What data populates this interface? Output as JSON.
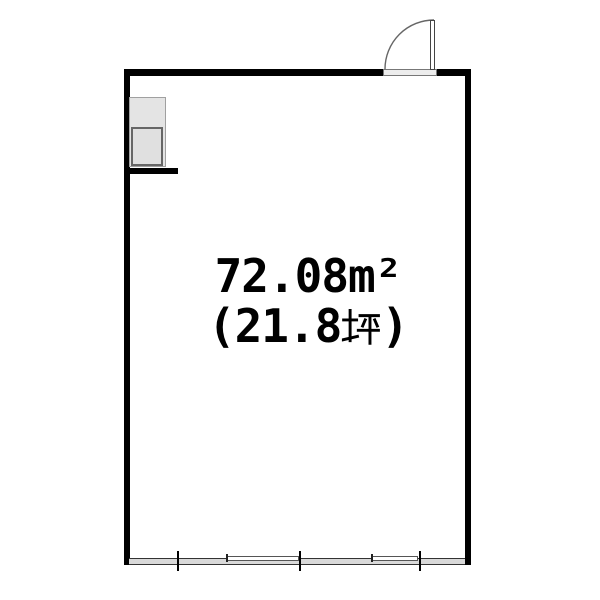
{
  "floorplan": {
    "area_sqm_label": "72.08m²",
    "tsubo_prefix": "(21.8",
    "tsubo_kanji": "坪",
    "tsubo_suffix": ")",
    "icons": {
      "tsubo_kanji_glyph": "坪",
      "door_swing": "quarter-arc"
    },
    "colors": {
      "wall": "#000000",
      "fixture_fill": "#e4e4e4",
      "fixture_inner_fill": "#e0e0e0",
      "window_fill": "#d9d9d9",
      "threshold_fill": "#ededed",
      "outline_gray": "#666666",
      "text": "#000000"
    }
  }
}
